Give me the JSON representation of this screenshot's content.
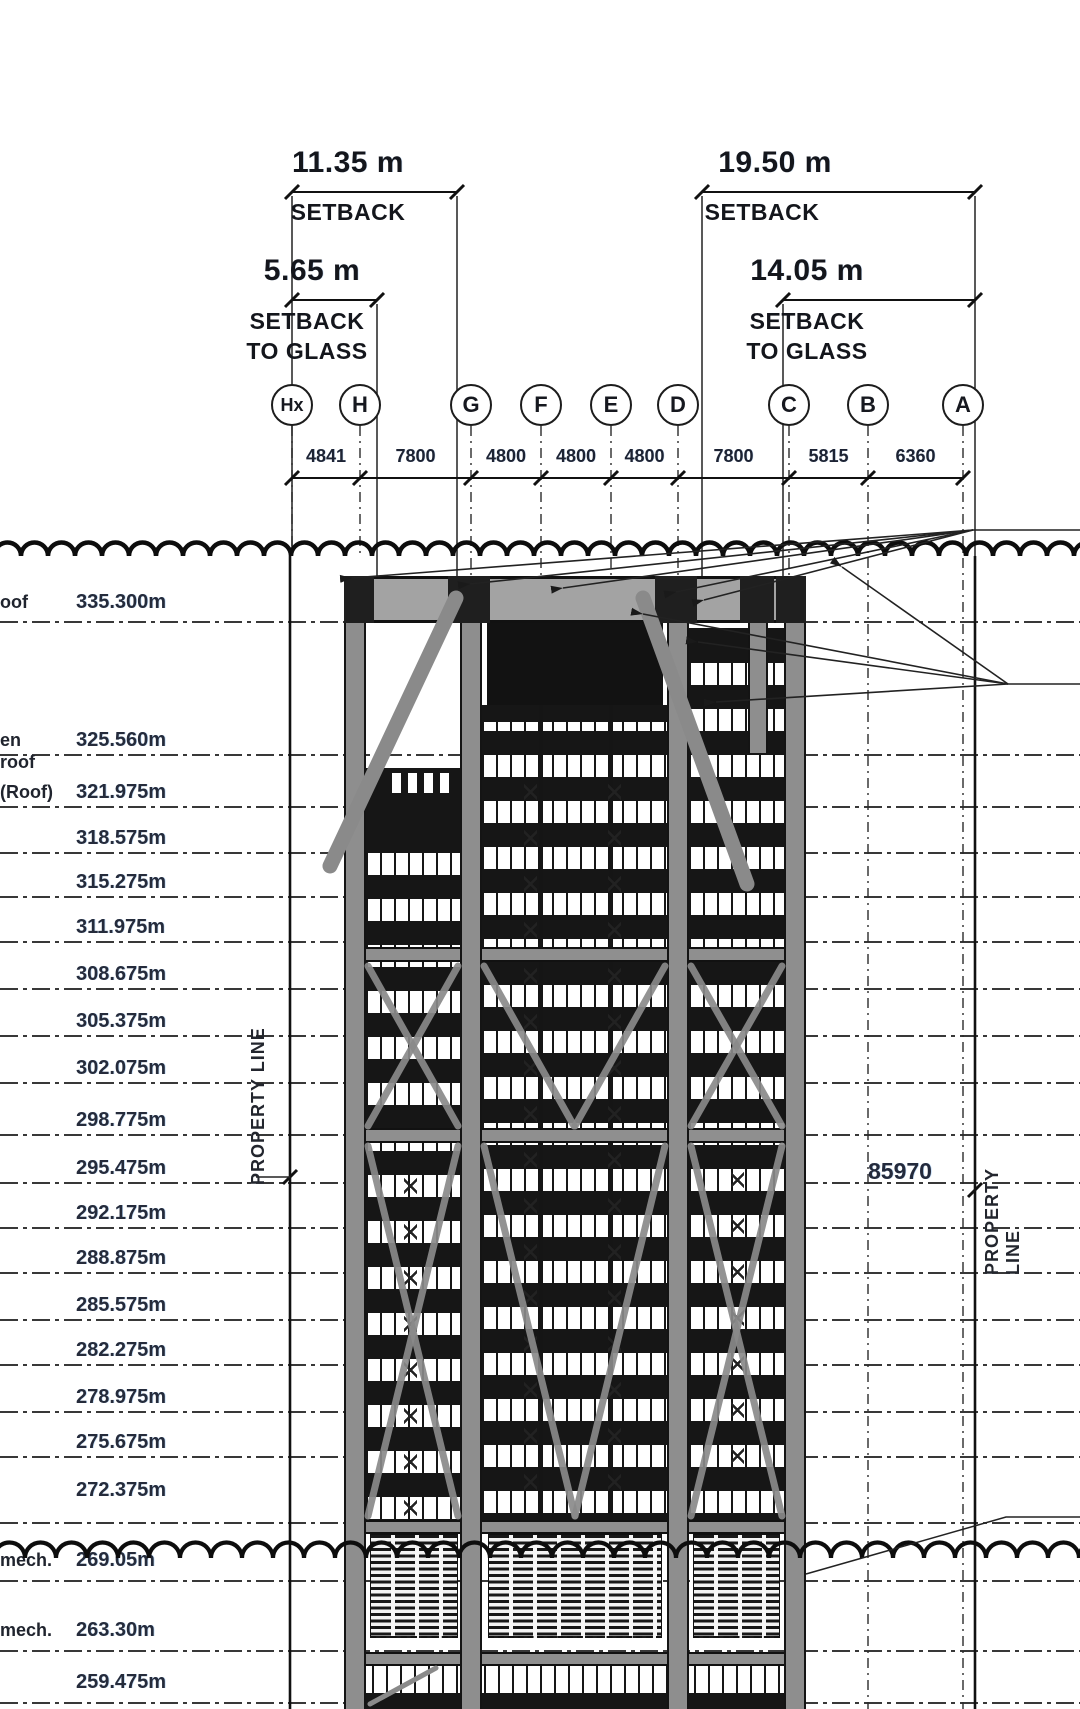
{
  "setbacks": {
    "left_outer": {
      "value": "11.35 m",
      "label1": "SETBACK",
      "label2": ""
    },
    "left_inner": {
      "value": "5.65 m",
      "label1": "SETBACK",
      "label2": "TO GLASS"
    },
    "right_outer": {
      "value": "19.50 m",
      "label1": "SETBACK",
      "label2": ""
    },
    "right_inner": {
      "value": "14.05 m",
      "label1": "SETBACK",
      "label2": "TO GLASS"
    }
  },
  "grid_bubbles": [
    "Hx",
    "H",
    "G",
    "F",
    "E",
    "D",
    "C",
    "B",
    "A"
  ],
  "grid_spacings": [
    "4841",
    "7800",
    "4800",
    "4800",
    "4800",
    "7800",
    "5815",
    "6360"
  ],
  "levels": [
    {
      "prefix": "oof",
      "value": "335.300m"
    },
    {
      "prefix": "en roof",
      "value": "325.560m"
    },
    {
      "prefix": "(Roof)",
      "value": "321.975m"
    },
    {
      "prefix": "",
      "value": "318.575m"
    },
    {
      "prefix": "",
      "value": "315.275m"
    },
    {
      "prefix": "",
      "value": "311.975m"
    },
    {
      "prefix": "",
      "value": "308.675m"
    },
    {
      "prefix": "",
      "value": "305.375m"
    },
    {
      "prefix": "",
      "value": "302.075m"
    },
    {
      "prefix": "",
      "value": "298.775m"
    },
    {
      "prefix": "",
      "value": "295.475m"
    },
    {
      "prefix": "",
      "value": "292.175m"
    },
    {
      "prefix": "",
      "value": "288.875m"
    },
    {
      "prefix": "",
      "value": "285.575m"
    },
    {
      "prefix": "",
      "value": "282.275m"
    },
    {
      "prefix": "",
      "value": "278.975m"
    },
    {
      "prefix": "",
      "value": "275.675m"
    },
    {
      "prefix": "",
      "value": "272.375m"
    },
    {
      "prefix": "mech.",
      "value": "269.05m"
    },
    {
      "prefix": "mech.",
      "value": "263.30m"
    },
    {
      "prefix": "",
      "value": "259.475m"
    }
  ],
  "property_line_left": "PROPERTY LINE",
  "property_line_right": "PROPERTY LINE",
  "overall_width_dimension": "85970"
}
